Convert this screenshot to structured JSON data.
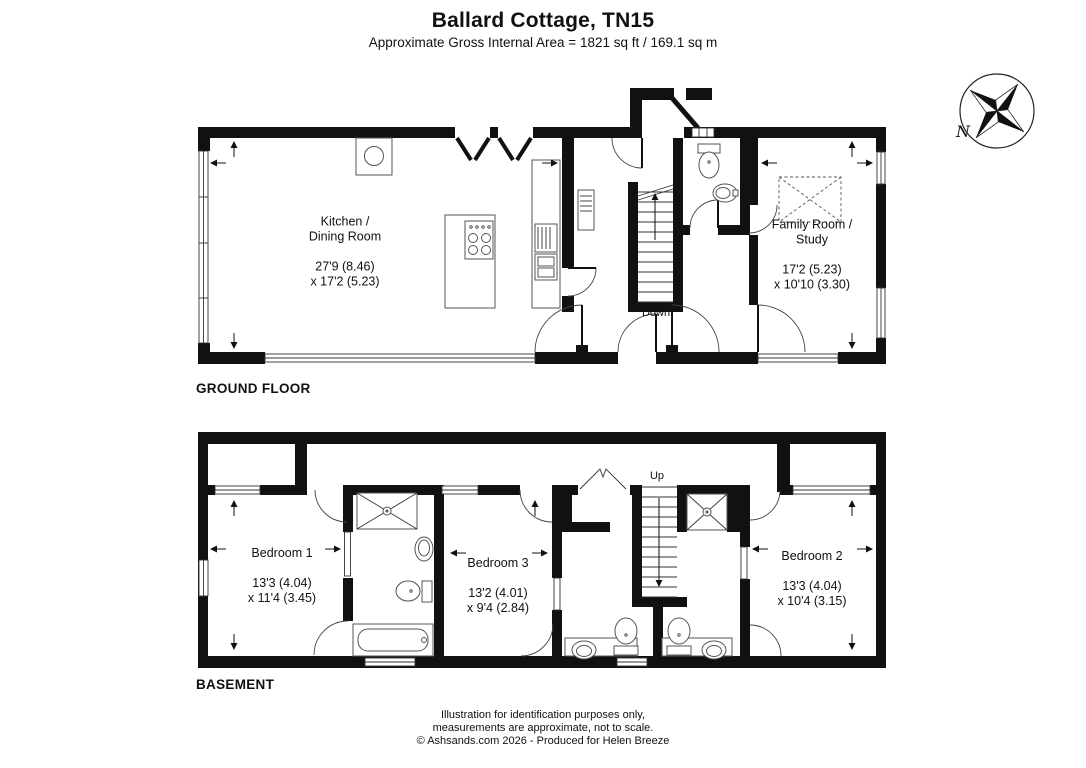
{
  "header": {
    "title": "Ballard Cottage, TN15",
    "subtitle": "Approximate Gross Internal Area = 1821 sq ft / 169.1 sq m"
  },
  "compass": {
    "north_label": "N"
  },
  "ground_floor": {
    "label": "GROUND FLOOR",
    "stairs_label": "Down",
    "rooms": {
      "kitchen_dining": {
        "name": "Kitchen /\nDining Room",
        "dims": "27'9 (8.46)\nx 17'2 (5.23)"
      },
      "family_study": {
        "name": "Family Room /\nStudy",
        "dims": "17'2 (5.23)\nx 10'10 (3.30)"
      }
    }
  },
  "basement": {
    "label": "BASEMENT",
    "stairs_label": "Up",
    "rooms": {
      "bedroom_1": {
        "name": "Bedroom 1",
        "dims": "13'3 (4.04)\nx 11'4 (3.45)"
      },
      "bedroom_3": {
        "name": "Bedroom 3",
        "dims": "13'2 (4.01)\nx 9'4 (2.84)"
      },
      "bedroom_2": {
        "name": "Bedroom 2",
        "dims": "13'3 (4.04)\nx 10'4 (3.15)"
      }
    }
  },
  "footer": {
    "line1": "Illustration for identification purposes only,",
    "line2": "measurements are approximate, not to scale.",
    "line3": "© Ashsands.com 2026 - Produced for Helen Breeze"
  }
}
